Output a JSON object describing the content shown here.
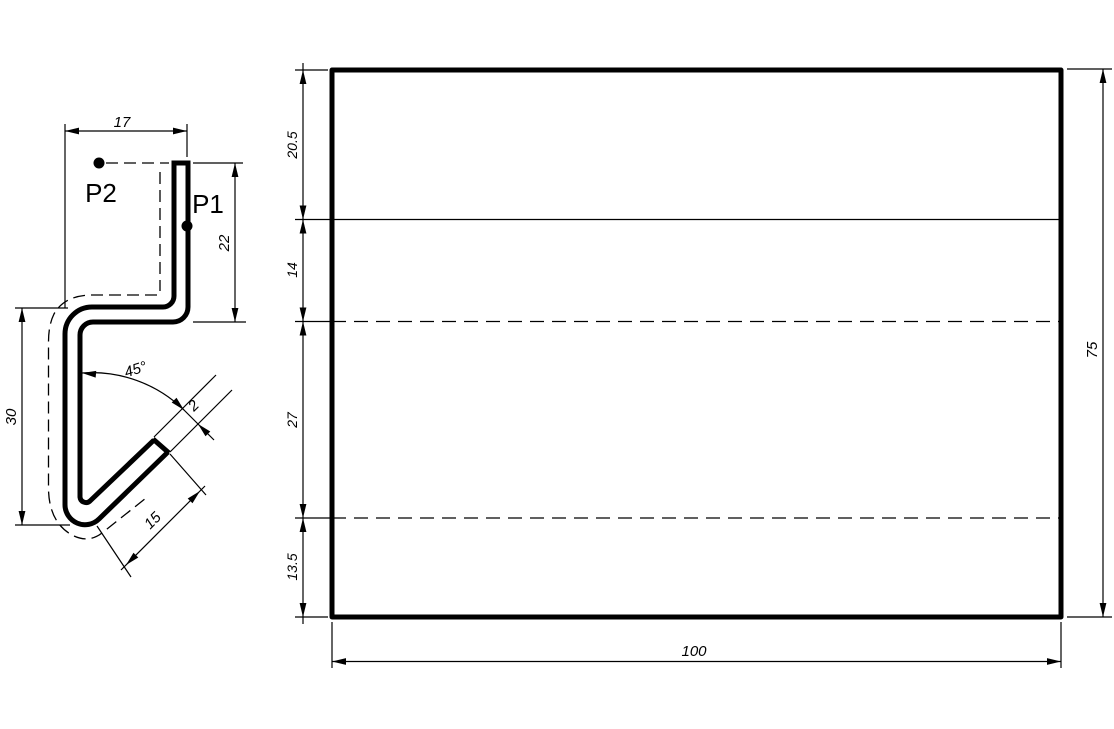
{
  "drawing": {
    "background_color": "#ffffff",
    "line_color": "#000000",
    "profile_view": {
      "point_labels": {
        "p1": "P1",
        "p2": "P2"
      },
      "dims": {
        "top_width": "17",
        "right_height": "22",
        "left_height": "30",
        "bend_angle": "45°",
        "thickness": "2",
        "flange_length": "15"
      }
    },
    "flat_view": {
      "dims": {
        "segments": [
          "20.5",
          "14",
          "27",
          "13.5"
        ],
        "total_height": "75",
        "total_width": "100"
      }
    }
  }
}
